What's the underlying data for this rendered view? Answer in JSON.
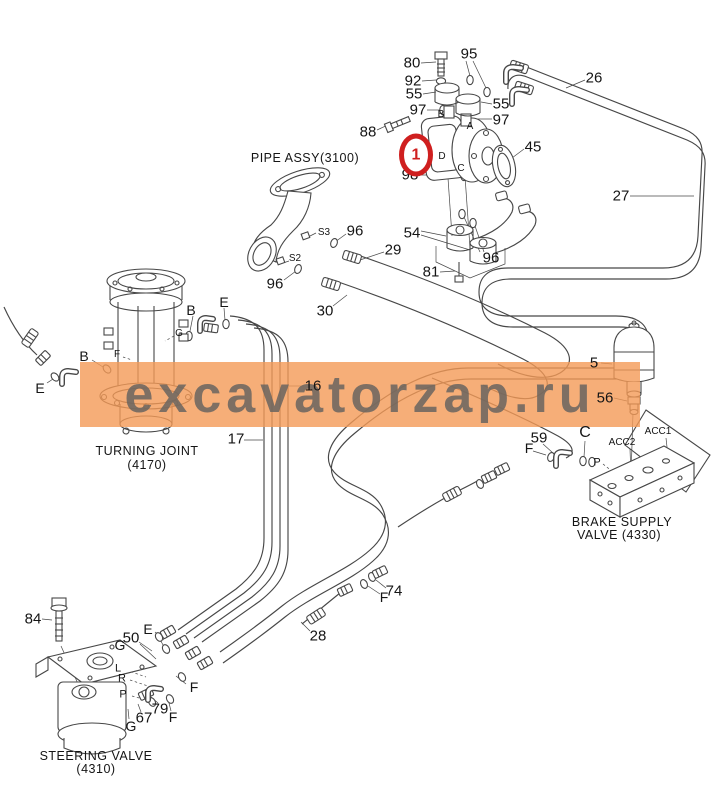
{
  "watermark": {
    "text": "excavatorzap.ru",
    "band_color": "rgba(244,154,86,0.80)",
    "text_color": "rgba(105,100,95,0.85)"
  },
  "highlight": {
    "text": "1",
    "color": "#cf1f1f"
  },
  "labels": [
    {
      "t": "80",
      "x": 412,
      "y": 63,
      "s": 15,
      "k": "part"
    },
    {
      "t": "92",
      "x": 413,
      "y": 81,
      "s": 15,
      "k": "part"
    },
    {
      "t": "55",
      "x": 414,
      "y": 94,
      "s": 15,
      "k": "part"
    },
    {
      "t": "97",
      "x": 418,
      "y": 110,
      "s": 15,
      "k": "part"
    },
    {
      "t": "95",
      "x": 469,
      "y": 54,
      "s": 15,
      "k": "part"
    },
    {
      "t": "55",
      "x": 501,
      "y": 104,
      "s": 15,
      "k": "part"
    },
    {
      "t": "97",
      "x": 501,
      "y": 120,
      "s": 15,
      "k": "part"
    },
    {
      "t": "26",
      "x": 594,
      "y": 78,
      "s": 15,
      "k": "part"
    },
    {
      "t": "88",
      "x": 368,
      "y": 132,
      "s": 15,
      "k": "part"
    },
    {
      "t": "98",
      "x": 410,
      "y": 175,
      "s": 15,
      "k": "part"
    },
    {
      "t": "45",
      "x": 533,
      "y": 147,
      "s": 15,
      "k": "part"
    },
    {
      "t": "27",
      "x": 621,
      "y": 196,
      "s": 15,
      "k": "part"
    },
    {
      "t": "54",
      "x": 412,
      "y": 233,
      "s": 15,
      "k": "part"
    },
    {
      "t": "96",
      "x": 355,
      "y": 231,
      "s": 15,
      "k": "part"
    },
    {
      "t": "29",
      "x": 393,
      "y": 250,
      "s": 15,
      "k": "part"
    },
    {
      "t": "96",
      "x": 275,
      "y": 284,
      "s": 15,
      "k": "part"
    },
    {
      "t": "30",
      "x": 325,
      "y": 311,
      "s": 15,
      "k": "part"
    },
    {
      "t": "96",
      "x": 491,
      "y": 258,
      "s": 15,
      "k": "part"
    },
    {
      "t": "81",
      "x": 431,
      "y": 272,
      "s": 15,
      "k": "part"
    },
    {
      "t": "16",
      "x": 313,
      "y": 386,
      "s": 15,
      "k": "part"
    },
    {
      "t": "17",
      "x": 236,
      "y": 439,
      "s": 15,
      "k": "part"
    },
    {
      "t": "5",
      "x": 594,
      "y": 363,
      "s": 15,
      "k": "part"
    },
    {
      "t": "56",
      "x": 605,
      "y": 398,
      "s": 15,
      "k": "part"
    },
    {
      "t": "59",
      "x": 539,
      "y": 438,
      "s": 15,
      "k": "part"
    },
    {
      "t": "74",
      "x": 394,
      "y": 591,
      "s": 15,
      "k": "part"
    },
    {
      "t": "28",
      "x": 318,
      "y": 636,
      "s": 15,
      "k": "part"
    },
    {
      "t": "84",
      "x": 33,
      "y": 619,
      "s": 15,
      "k": "part"
    },
    {
      "t": "50",
      "x": 131,
      "y": 638,
      "s": 15,
      "k": "part"
    },
    {
      "t": "79",
      "x": 160,
      "y": 709,
      "s": 15,
      "k": "part"
    },
    {
      "t": "67",
      "x": 144,
      "y": 718,
      "s": 15,
      "k": "part"
    },
    {
      "t": "B",
      "x": 84,
      "y": 356,
      "s": 14,
      "k": "port"
    },
    {
      "t": "E",
      "x": 40,
      "y": 388,
      "s": 14,
      "k": "port"
    },
    {
      "t": "B",
      "x": 191,
      "y": 310,
      "s": 14,
      "k": "port"
    },
    {
      "t": "E",
      "x": 224,
      "y": 302,
      "s": 14,
      "k": "port"
    },
    {
      "t": "C",
      "x": 585,
      "y": 433,
      "s": 16,
      "k": "port"
    },
    {
      "t": "F",
      "x": 529,
      "y": 448,
      "s": 14,
      "k": "port"
    },
    {
      "t": "F",
      "x": 384,
      "y": 597,
      "s": 14,
      "k": "port"
    },
    {
      "t": "E",
      "x": 148,
      "y": 629,
      "s": 14,
      "k": "port"
    },
    {
      "t": "G",
      "x": 120,
      "y": 645,
      "s": 14,
      "k": "port"
    },
    {
      "t": "F",
      "x": 194,
      "y": 687,
      "s": 14,
      "k": "port"
    },
    {
      "t": "F",
      "x": 173,
      "y": 717,
      "s": 14,
      "k": "port"
    },
    {
      "t": "G",
      "x": 131,
      "y": 726,
      "s": 14,
      "k": "port"
    },
    {
      "t": "S3",
      "x": 324,
      "y": 233,
      "s": 10,
      "k": "tiny"
    },
    {
      "t": "S2",
      "x": 295,
      "y": 259,
      "s": 10,
      "k": "tiny"
    },
    {
      "t": "A",
      "x": 470,
      "y": 127,
      "s": 10,
      "k": "tiny"
    },
    {
      "t": "B",
      "x": 441,
      "y": 115,
      "s": 10,
      "k": "tiny"
    },
    {
      "t": "D",
      "x": 442,
      "y": 157,
      "s": 10,
      "k": "tiny"
    },
    {
      "t": "C",
      "x": 461,
      "y": 169,
      "s": 10,
      "k": "tiny"
    },
    {
      "t": "G",
      "x": 179,
      "y": 334,
      "s": 10,
      "k": "tiny"
    },
    {
      "t": "F",
      "x": 117,
      "y": 355,
      "s": 10,
      "k": "tiny"
    },
    {
      "t": "L",
      "x": 118,
      "y": 669,
      "s": 11,
      "k": "tiny"
    },
    {
      "t": "R",
      "x": 122,
      "y": 679,
      "s": 11,
      "k": "tiny"
    },
    {
      "t": "P",
      "x": 123,
      "y": 695,
      "s": 11,
      "k": "tiny"
    },
    {
      "t": "P",
      "x": 597,
      "y": 463,
      "s": 11,
      "k": "tiny"
    },
    {
      "t": "ACC2",
      "x": 622,
      "y": 443,
      "s": 10,
      "k": "tiny"
    },
    {
      "t": "ACC1",
      "x": 658,
      "y": 432,
      "s": 10,
      "k": "tiny"
    },
    {
      "t": "PIPE ASSY(3100)",
      "x": 305,
      "y": 158,
      "s": 12.5,
      "k": "comp"
    },
    {
      "t": "TURNING JOINT",
      "x": 147,
      "y": 451,
      "s": 12.5,
      "k": "comp"
    },
    {
      "t": "(4170)",
      "x": 147,
      "y": 465,
      "s": 12.5,
      "k": "comp"
    },
    {
      "t": "STEERING VALVE",
      "x": 96,
      "y": 756,
      "s": 12.5,
      "k": "comp"
    },
    {
      "t": "(4310)",
      "x": 96,
      "y": 769,
      "s": 12.5,
      "k": "comp"
    },
    {
      "t": "BRAKE SUPPLY",
      "x": 622,
      "y": 522,
      "s": 12.5,
      "k": "comp"
    },
    {
      "t": "VALVE (4330)",
      "x": 619,
      "y": 535,
      "s": 12.5,
      "k": "comp"
    }
  ]
}
